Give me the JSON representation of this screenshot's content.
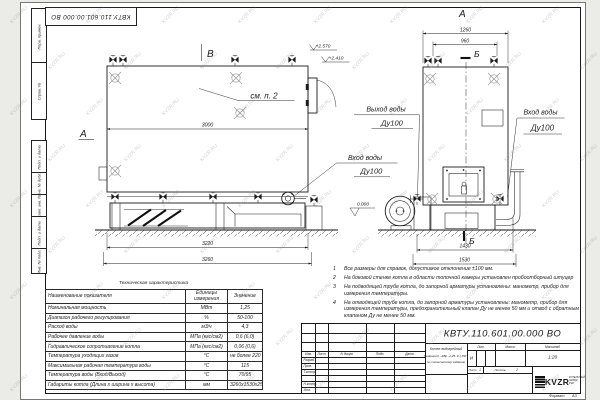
{
  "watermark": "KVZR.RU",
  "stamp_top": "КВТУ.110.601.00.000  ВО",
  "side_strip": [
    "Перв. примен.",
    "Справ. №",
    "Подп. и дата",
    "Инв. № дубл.",
    "Взам. инв. №",
    "Подп. и дата",
    "Инв. № подл."
  ],
  "drawing": {
    "view_label_b": "В",
    "view_label_a": "А",
    "section_label_a": "А",
    "section_label_b_top": "Б",
    "section_label_b_bottom": "Б",
    "note_ref": "см. п. 2",
    "elevation_top": "+2.570",
    "elevation_mid": "+2.410",
    "elevation_zero": "0.000",
    "dims": {
      "front_width": "3000",
      "front_base": "3220",
      "front_total": "3260",
      "side_width": "1260",
      "side_inner": "960",
      "side_base": "1430",
      "side_total": "1530"
    },
    "labels": {
      "outlet_line1": "Выход воды",
      "outlet_line2": "Ду100",
      "inlet_front_line1": "Вход воды",
      "inlet_front_line2": "Ду100",
      "inlet_side_line1": "Вход воды",
      "inlet_side_line2": "Ду100"
    }
  },
  "notes": {
    "items": [
      {
        "num": "1",
        "text": "Все размеры для справок, допустимое отклонение ±100 мм."
      },
      {
        "num": "2",
        "text": "На боковой стенке котла в области топочной камеры установлен пробоотборный штуцер"
      },
      {
        "num": "3",
        "text": "На  подводящей трубе котла, до запорной арматуры установлены: манометр, прибор для измерения температуры."
      },
      {
        "num": "4",
        "text": "На отводящей трубе котла, до запорной арматуры установлены: манометр, прибор для измерения температуры, предохранительный клапан Ду не менее 50 мм и отвод с обратным клапаном Ду не менее 50 мм."
      }
    ]
  },
  "spec_table": {
    "title": "Техническая характеристика",
    "col_name": "Наименование показателя",
    "col_units": "Единицы измерения",
    "col_value": "Значение",
    "rows": [
      {
        "name": "Номинальная мощность",
        "units": "МВт",
        "value": "1,25"
      },
      {
        "name": "Диапазон рабочего регулирования",
        "units": "%",
        "value": "50-100"
      },
      {
        "name": "Расход воды",
        "units": "м3/ч",
        "value": "4,3"
      },
      {
        "name": "Рабочее давление воды",
        "units": "МПа (кгс/см2)",
        "value": "0,6 (6,0)"
      },
      {
        "name": "Гидравлическое сопротивление котла",
        "units": "МПа (кгс/см2)",
        "value": "0,06 (0,6)"
      },
      {
        "name": "Температура уходящих газов",
        "units": "°С",
        "value": "не более 220"
      },
      {
        "name": "Максимальная рабочая температура воды",
        "units": "°С",
        "value": "115"
      },
      {
        "name": "Температура воды (Вход/Выход)",
        "units": "°С",
        "value": "70/95"
      },
      {
        "name": "Габариты котла (Длина х ширина х высота)",
        "units": "мм",
        "value": "3260х1530х2570"
      }
    ]
  },
  "title_block": {
    "doc_number": "КВТУ.110.601.00.000  ВО",
    "product_line1": "Котел водогрейный",
    "product_line2": "Heatexpert - КВр -1,25- К ( РЖ )",
    "product_line3": "по техническому заданию",
    "cols": {
      "izm": "Изм.",
      "list": "Лист",
      "doc": "N докум.",
      "sign": "Подп.",
      "date": "Дата"
    },
    "roles": [
      "Разраб.",
      "Пров.",
      "Т.контр.",
      "",
      "Н.контр.",
      "Утв."
    ],
    "lit_label": "Лит.",
    "lit_value": "И",
    "mass_label": "Масса",
    "scale_label": "Масштаб",
    "scale_value": "1:20",
    "sheet_label": "Лист",
    "sheet_value": "1",
    "sheets_label": "Листов",
    "sheets_value": "2",
    "logo_text": "KVZR",
    "logo_sub": "КОТЕЛЬНЫЙ ЗАВОД РЭП",
    "format_label": "Формат",
    "format_value": "А3"
  }
}
